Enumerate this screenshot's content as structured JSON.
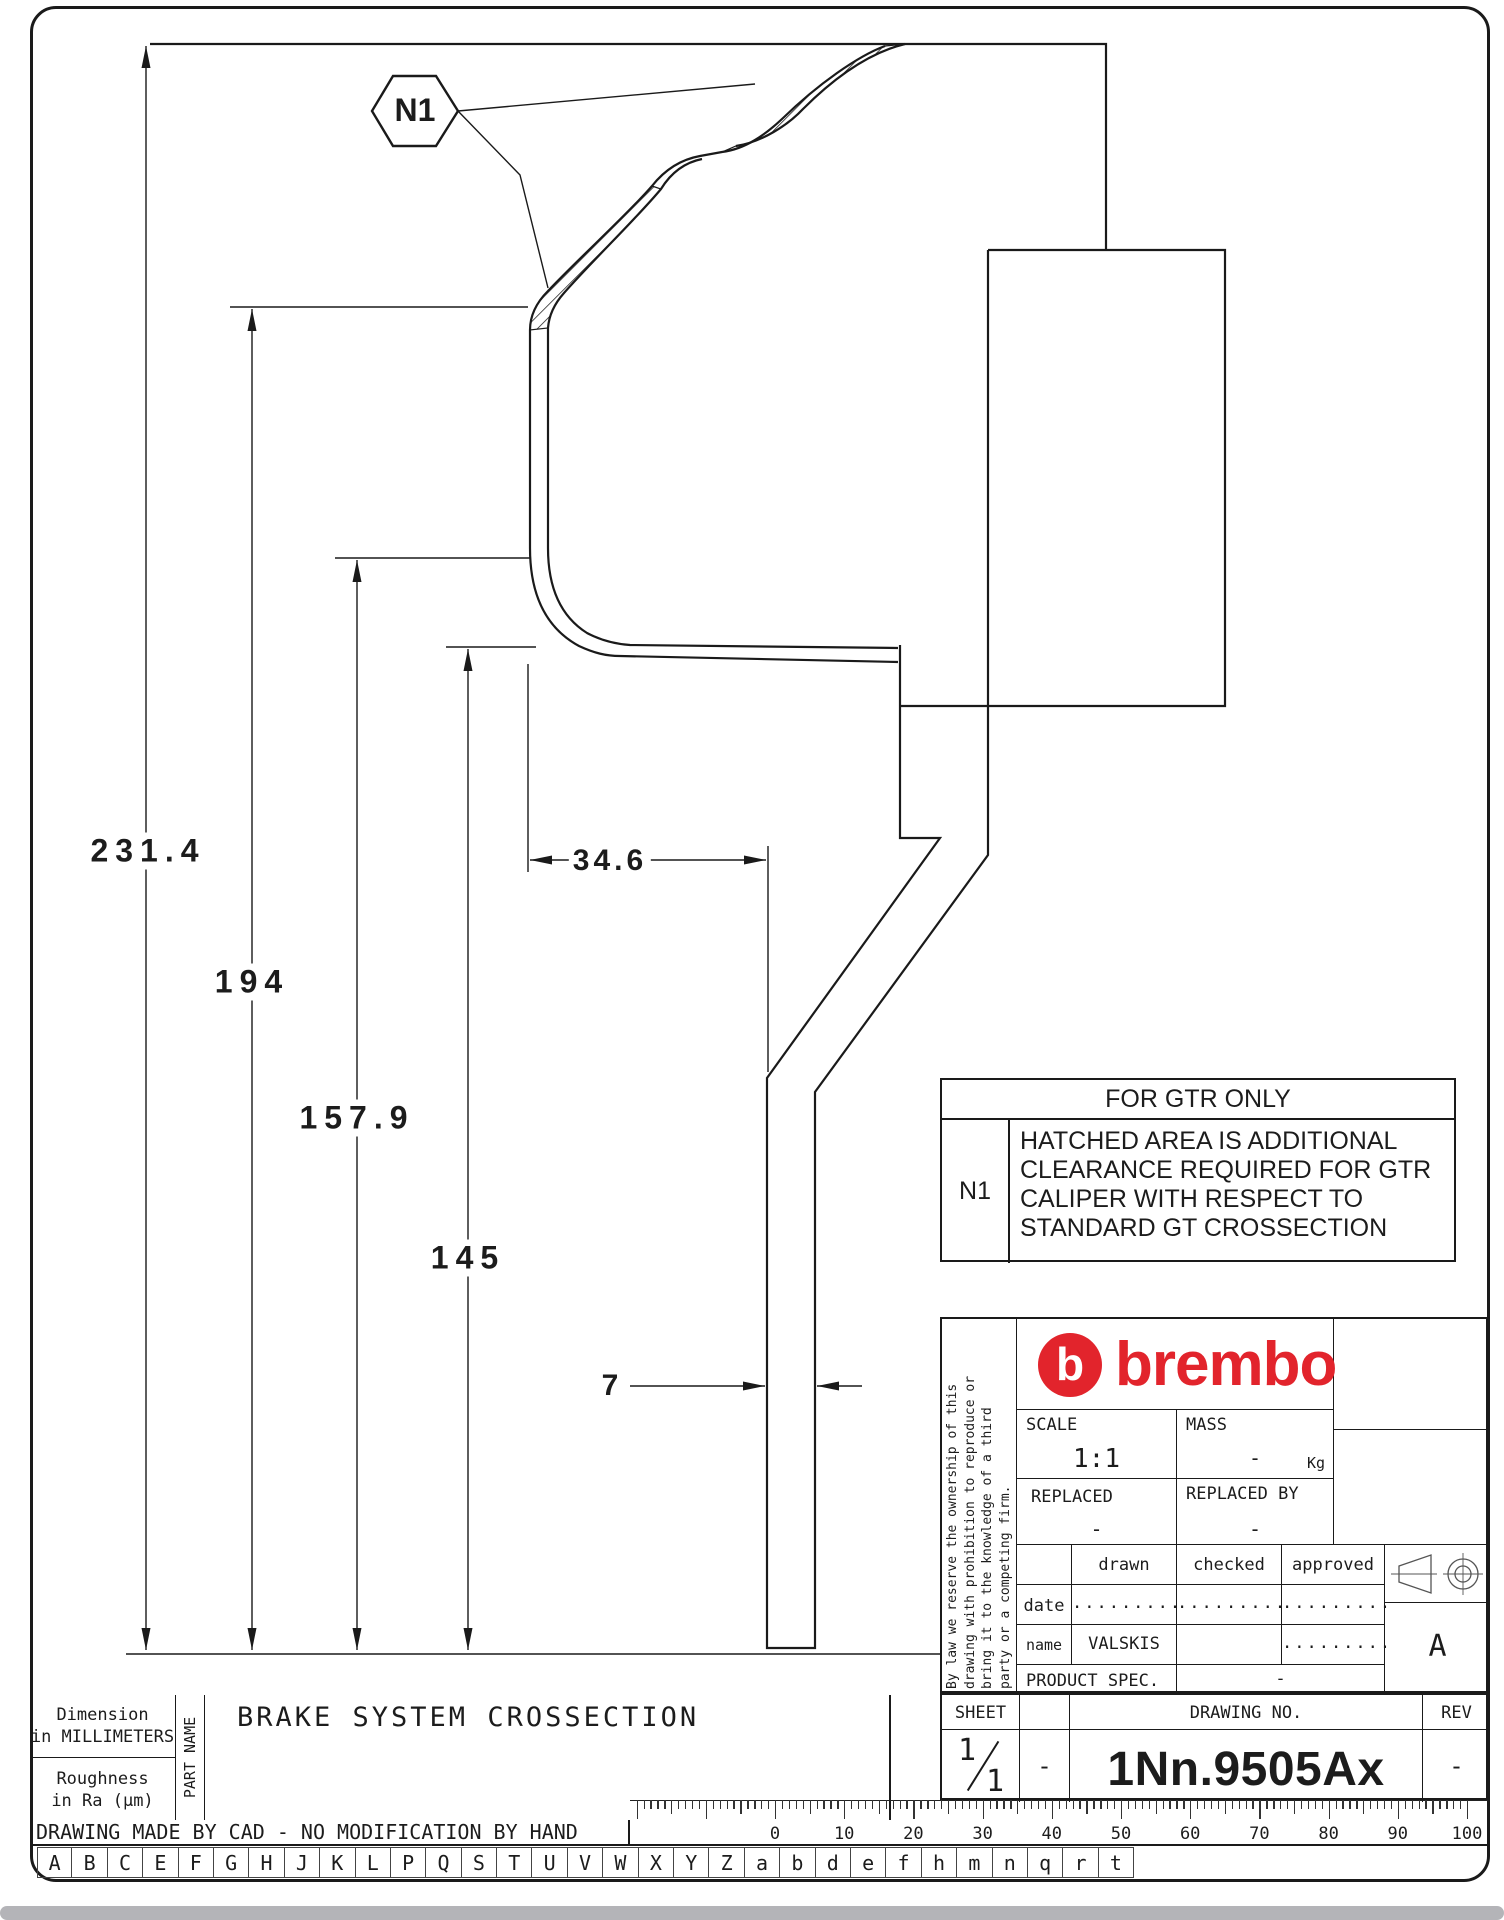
{
  "page": {
    "background": "#ffffff",
    "line_color": "#1a1a1a",
    "brand_red": "#e2242c"
  },
  "drawing": {
    "callout_label": "N1",
    "dim_overall": "231.4",
    "dim_hat_depth": "194",
    "dim_inner": "157.9",
    "dim_flange": "145",
    "dim_width": "34.6",
    "dim_thickness": "7"
  },
  "note_table": {
    "header": "FOR GTR ONLY",
    "ref": "N1",
    "line1": "HATCHED AREA IS ADDITIONAL",
    "line2": "CLEARANCE REQUIRED FOR GTR",
    "line3": "CALIPER WITH RESPECT TO",
    "line4": "STANDARD GT CROSSECTION"
  },
  "title_block": {
    "legal_line1": "By law we reserve the ownership of this",
    "legal_line2": "drawing with prohibition to reproduce or",
    "legal_line3": "bring it to the knowledge of a third",
    "legal_line4": "party or a competing firm.",
    "brand": "brembo",
    "brand_mark": "b",
    "scale_label": "SCALE",
    "scale_value": "1:1",
    "mass_label": "MASS",
    "mass_value": "-",
    "mass_unit": "Kg",
    "replaced_label": "REPLACED",
    "replaced_value": "-",
    "replaced_by_label": "REPLACED BY",
    "replaced_by_value": "-",
    "col_drawn": "drawn",
    "col_checked": "checked",
    "col_approved": "approved",
    "row_date_label": "date",
    "row_name_label": "name",
    "date_drawn": ".........",
    "date_checked": ".........",
    "date_approved": ".........",
    "name_drawn": "VALSKIS",
    "name_approved": ".........",
    "product_spec_label": "PRODUCT SPEC.",
    "product_spec_value": "-",
    "revision_letter": "A"
  },
  "sheet_bar": {
    "sheet_label": "SHEET",
    "sheet_numerator": "1",
    "sheet_denominator": "1",
    "dash": "-",
    "drawing_no_label": "DRAWING NO.",
    "drawing_no": "1Nn.9505Ax",
    "rev_label": "REV",
    "rev_value": "-"
  },
  "footer": {
    "dim_note_line1": "Dimension",
    "dim_note_line2": "in MILLIMETERS",
    "rough_note_line1": "Roughness",
    "rough_note_line2": "in Ra (μm)",
    "part_name_label": "PART NAME",
    "part_name": "BRAKE SYSTEM CROSSECTION",
    "cad_note": "DRAWING MADE BY CAD - NO MODIFICATION BY HAND",
    "ruler_labels": [
      "0",
      "10",
      "20",
      "30",
      "40",
      "50",
      "60",
      "70",
      "80",
      "90",
      "100"
    ],
    "letters": [
      "A",
      "B",
      "C",
      "E",
      "F",
      "G",
      "H",
      "J",
      "K",
      "L",
      "P",
      "Q",
      "S",
      "T",
      "U",
      "V",
      "W",
      "X",
      "Y",
      "Z",
      "a",
      "b",
      "d",
      "e",
      "f",
      "h",
      "m",
      "n",
      "q",
      "r",
      "t"
    ]
  }
}
